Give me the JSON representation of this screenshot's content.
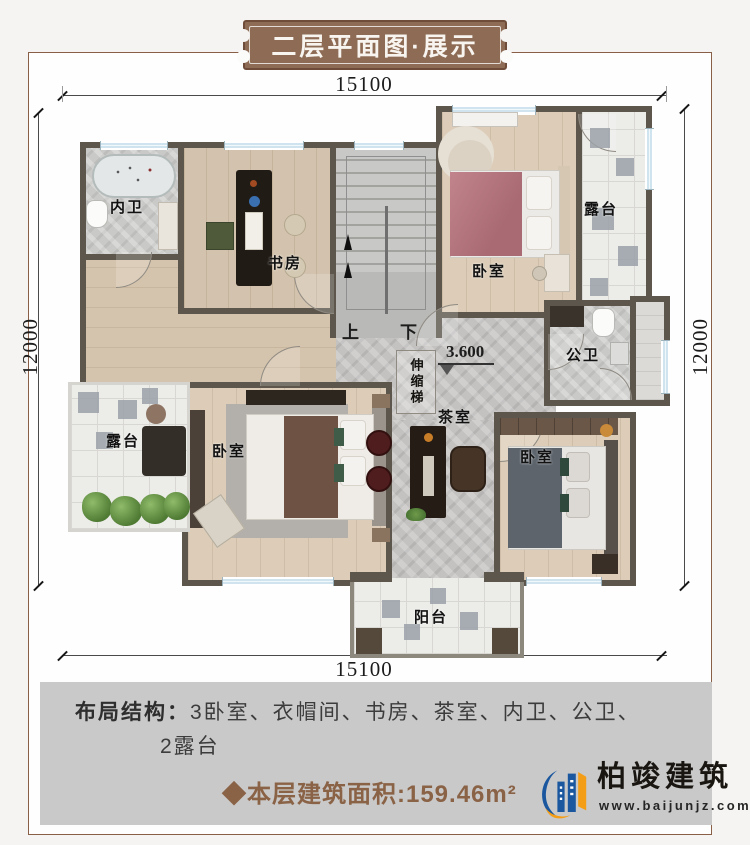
{
  "banner": {
    "title": "二层平面图·展示"
  },
  "dimensions": {
    "top": "15100",
    "bottom": "15100",
    "left": "12000",
    "right": "12000"
  },
  "plan": {
    "labels": {
      "ensuite_bath": "内卫",
      "study": "书房",
      "bedroom_top": "卧室",
      "terrace_right": "露台",
      "public_bath": "公卫",
      "tea_room": "茶室",
      "terrace_left": "露台",
      "bedroom_left": "卧室",
      "bedroom_right": "卧室",
      "balcony": "阳台",
      "ladder": "伸缩梯",
      "up": "上",
      "down": "下",
      "elevation": "3.600"
    }
  },
  "info": {
    "layout_label": "布局结构：",
    "layout_items": "3卧室、衣帽间、书房、茶室、内卫、公卫、",
    "layout_items2": "2露台",
    "area": "◆本层建筑面积:159.46m²"
  },
  "logo": {
    "name": "柏竣建筑",
    "website": "www.baijunjz.com"
  },
  "colors": {
    "banner_brown": "#8d6b54",
    "frame_brown": "#8a5f48",
    "accent_brown": "#8a6246",
    "logo_blue": "#1b579f",
    "logo_orange": "#f49d16",
    "wall": "#5c564c",
    "info_bg": "#c9c9c9"
  }
}
